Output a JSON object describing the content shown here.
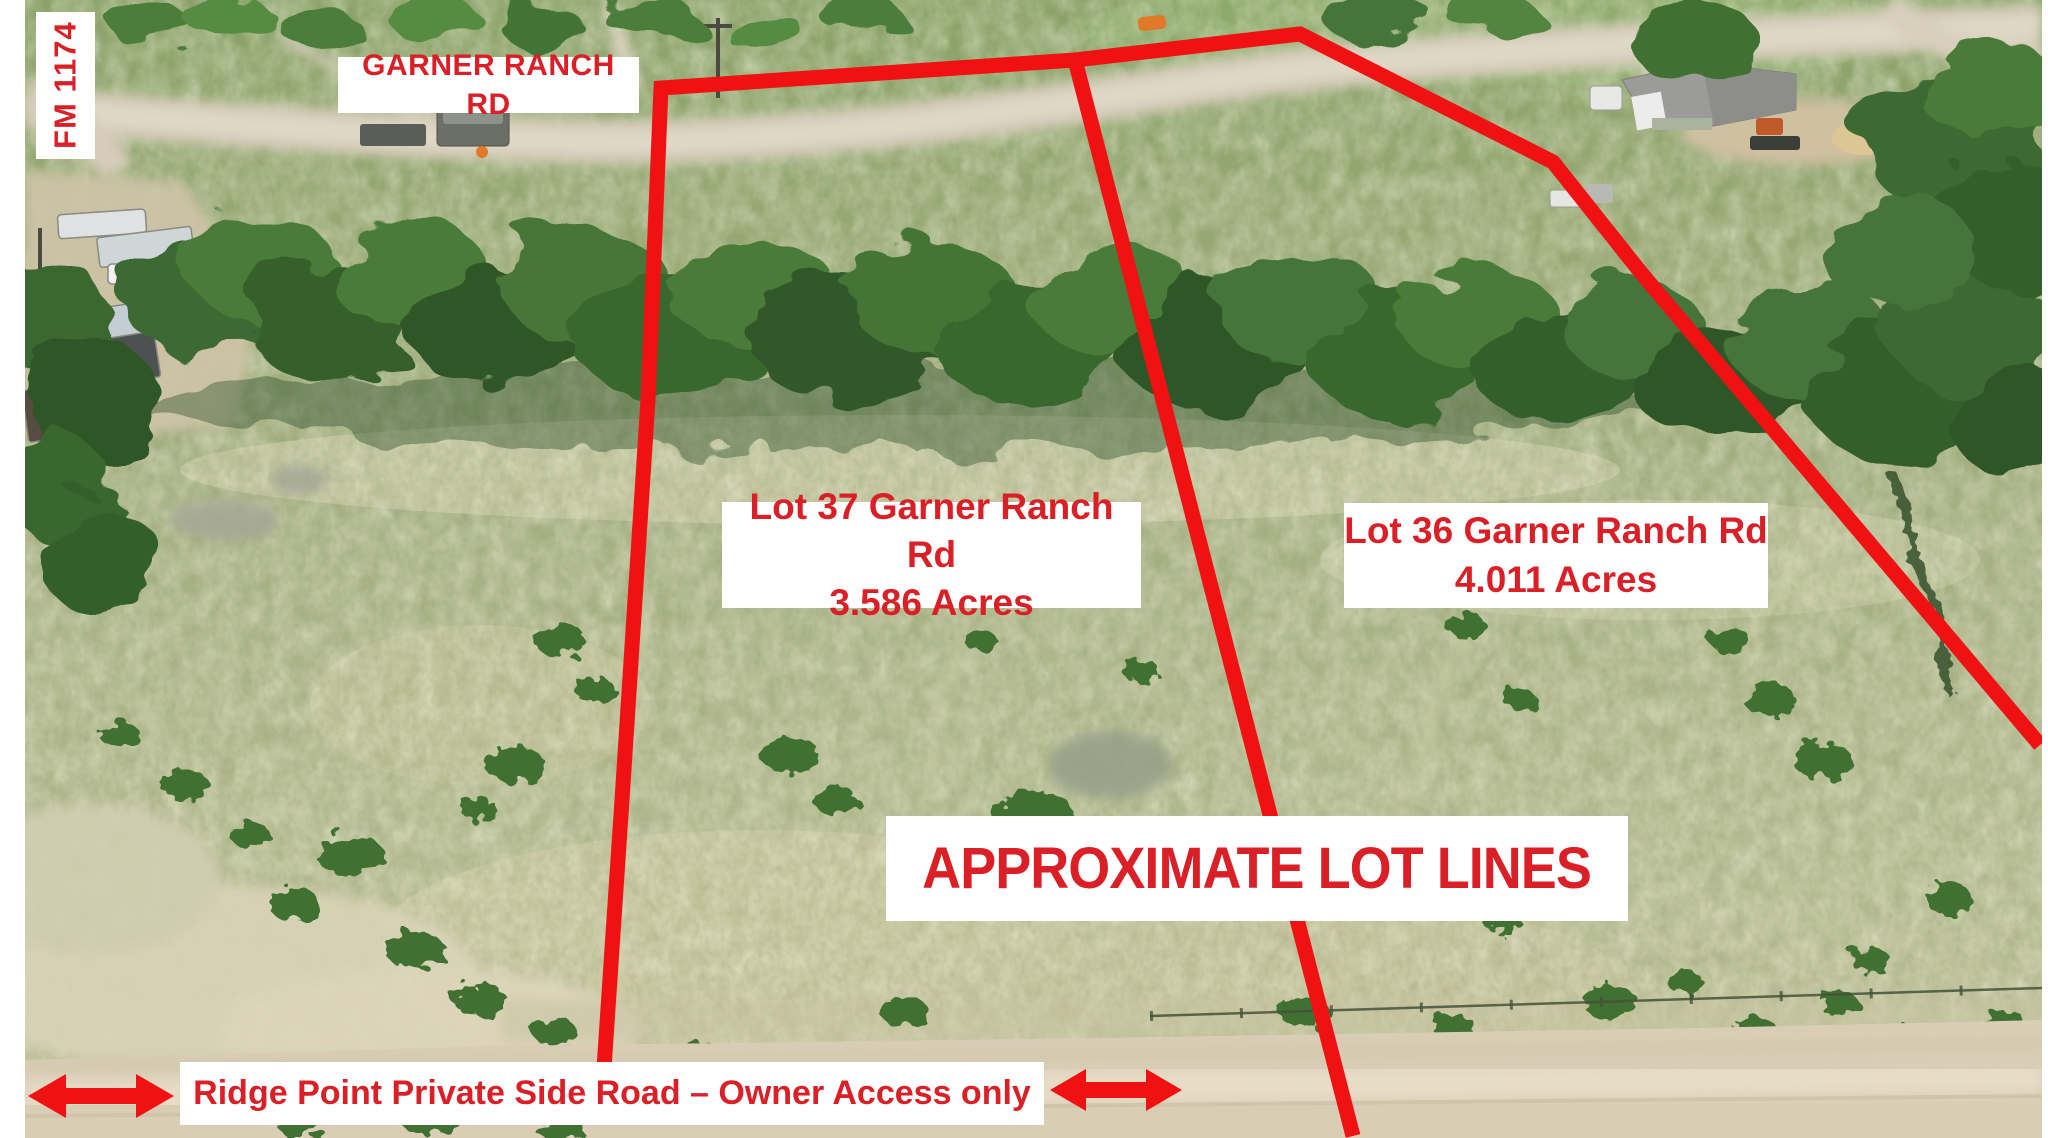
{
  "labels": {
    "fm_road": "FM 1174",
    "garner_road": "GARNER RANCH RD",
    "overlay_note": "APPROXIMATE LOT LINES",
    "bottom_road": "Ridge Point Private Side Road – Owner Access only"
  },
  "lots": [
    {
      "title": "Lot 37 Garner Ranch Rd",
      "acreage": "3.586 Acres"
    },
    {
      "title": "Lot 36 Garner Ranch Rd",
      "acreage": "4.011 Acres"
    }
  ],
  "colors": {
    "line_red": "#f01212",
    "text_red": "#da1f27",
    "label_background": "#ffffff"
  }
}
